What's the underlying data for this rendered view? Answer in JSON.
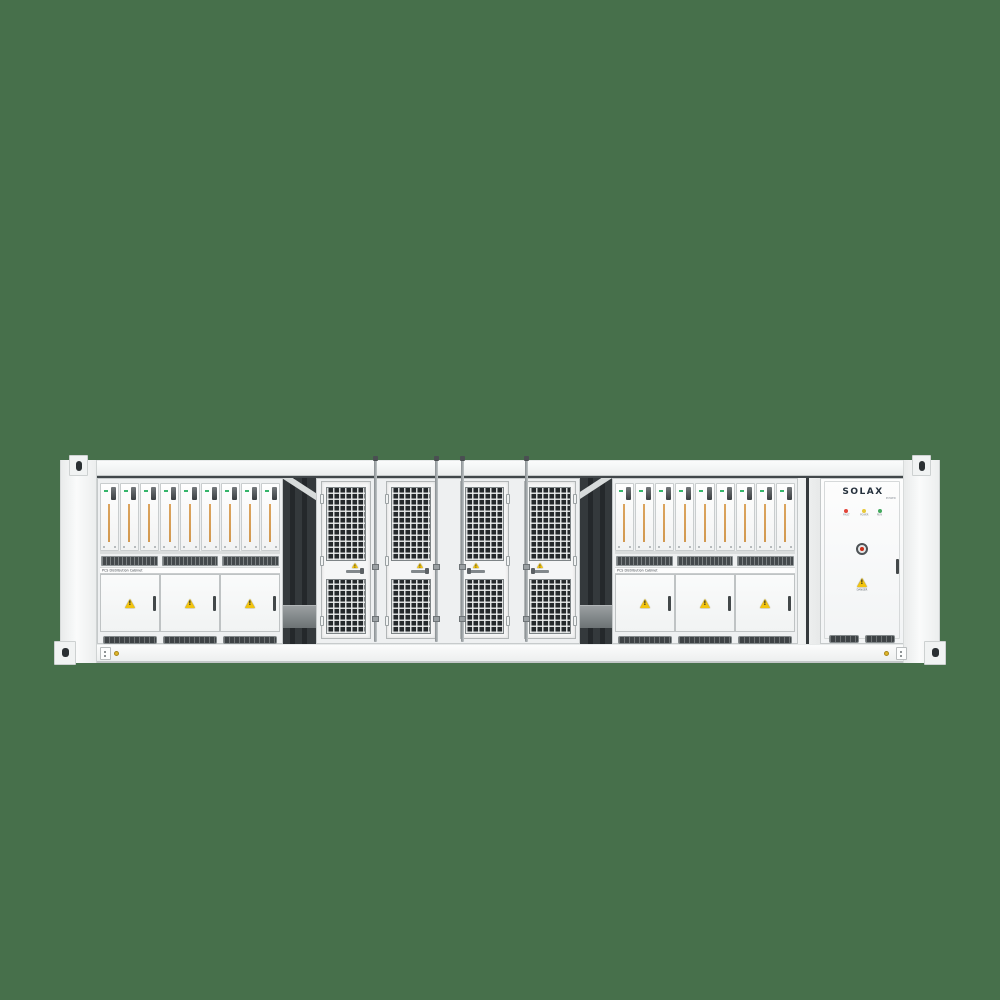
{
  "title": "Containerized battery energy storage system — front render",
  "background_color": "#47704b",
  "branding": {
    "logo": "SOLAX",
    "logo_sub": "POWER"
  },
  "pcs_rack": {
    "label": "PCS Distribution Cabinet",
    "module_count": 9,
    "door_count": 3,
    "vent_count": 3,
    "bottom_vent_count": 3,
    "module_stripe_color": "#dba45e"
  },
  "mesh_bay": {
    "door_count": 4
  },
  "control_cabinet": {
    "leds": [
      {
        "name": "fault-led",
        "label": "FAULT",
        "color": "#e2453a"
      },
      {
        "name": "power-led",
        "label": "POWER",
        "color": "#e8c93a"
      },
      {
        "name": "run-led",
        "label": "RUN",
        "color": "#43a95e"
      }
    ],
    "warning_label": "DANGER"
  },
  "colors": {
    "panel": "#f6f7f7",
    "interior": "#3f4548",
    "mesh": "#25292c",
    "warning_yellow": "#f2c40e"
  }
}
